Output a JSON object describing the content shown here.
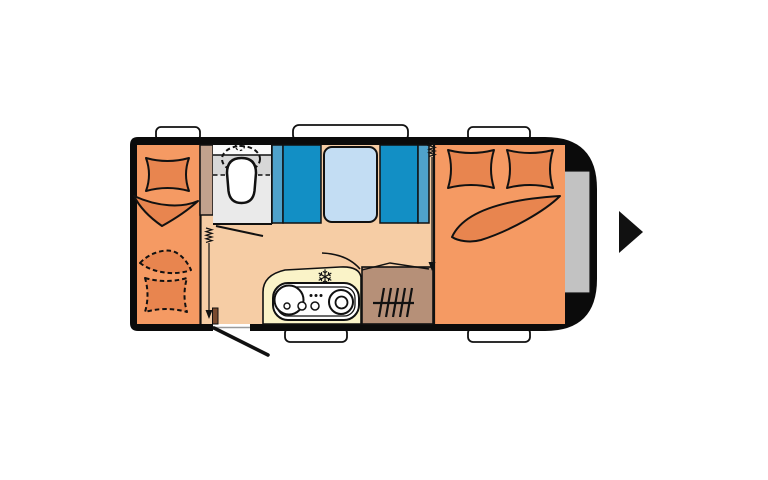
{
  "diagram": {
    "kind": "caravan floor plan (top view)",
    "direction_of_travel": "right",
    "areas": [
      {
        "id": "rear-bed",
        "label": "rear single bed with solid pillow and blanket, plus dashed (convertible) pillow and blanket"
      },
      {
        "id": "washroom",
        "label": "washroom with cassette toilet and counter band"
      },
      {
        "id": "dinette",
        "label": "dinette with two facing bench seats and table"
      },
      {
        "id": "kitchen",
        "label": "kitchen block with sink, hob burners and freezer symbol"
      },
      {
        "id": "heater-cabinet",
        "label": "cabinet with heater symbol"
      },
      {
        "id": "front-bed",
        "label": "front double bed with two pillows and folded blanket"
      },
      {
        "id": "front-locker",
        "label": "gray front locker strip in caravan nose"
      },
      {
        "id": "entrance-door",
        "label": "entrance door shown open at bottom wall"
      },
      {
        "id": "curtain-left",
        "label": "curtain track with coil and pull arrow beside washroom"
      },
      {
        "id": "curtain-right",
        "label": "curtain track with coil and pull arrow at bedroom divider"
      }
    ],
    "windows": {
      "top": 3,
      "bottom": 2
    }
  },
  "icons": {
    "freezer_snowflake": "❄",
    "travel_direction_arrow": "right-pointing triangle",
    "heater_symbol": "five hatched lines with crossbar",
    "curtain_coil": "small zigzag spring"
  },
  "colors": {
    "body_black": "#0b0b0b",
    "floor": "#f6cda5",
    "bed": "#f59a63",
    "bedding": "#e8854f",
    "wardrobe_tan": "#c2a28d",
    "bathroom": "#eaeaea",
    "bathroom_top": "#fafafa",
    "bathroom_band": "#d7d7d7",
    "bench_blue": "#128fc5",
    "bench_side_blue": "#4fa2cb",
    "table_blue": "#c3ddf3",
    "kitchen_cream": "#faf3c8",
    "cabinet_brown": "#b69078",
    "door_stub_brown": "#7a4a2e",
    "front_locker_gray": "#c2c2c2",
    "window_white": "#ffffff",
    "threshold_gray": "#9a9a9a"
  }
}
